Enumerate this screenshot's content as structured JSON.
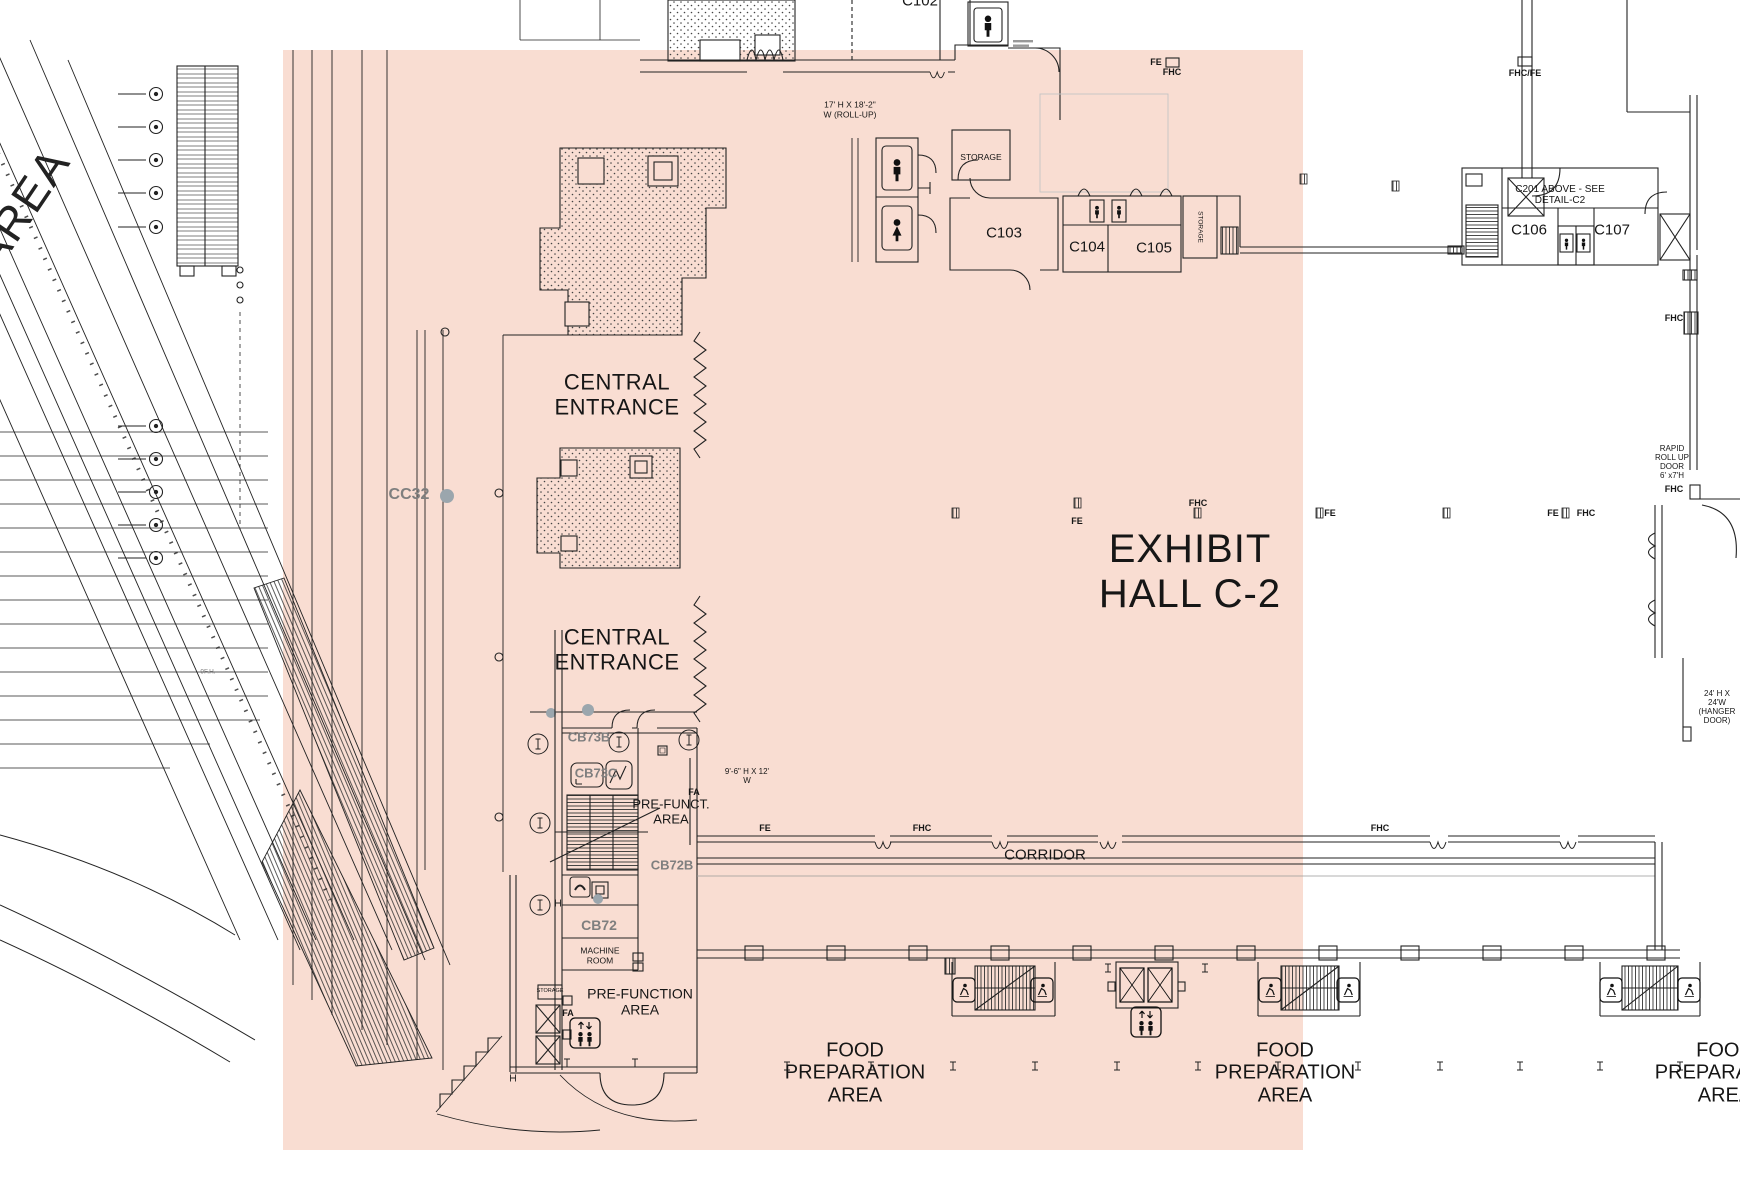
{
  "colors": {
    "highlight_fill": "#f9ddd2",
    "gray_label": "#7f7f7f",
    "grid_dot_gray": "#9ba6ad",
    "line_color": "#222222"
  },
  "hall": {
    "name": "EXHIBIT\nHALL C-2"
  },
  "labels": {
    "area": "AREA",
    "c102": "C102",
    "rollup_note": "17' H X 18'-2\"\nW (ROLL-UP)",
    "fe": "FE",
    "fhc": "FHC",
    "fhc_fe": "FHC/FE",
    "storage": "STORAGE",
    "c103": "C103",
    "c104": "C104",
    "c105": "C105",
    "c201_note": "C201 ABOVE - SEE\nDETAIL-C2",
    "c106": "C106",
    "c107": "C107",
    "central_entrance": "CENTRAL\nENTRANCE",
    "cc32": "CC32",
    "rapid_door": "RAPID\nROLL UP\nDOOR\n6' x7'H",
    "hanger_door": "24' H X 24'W\n(HANGER\nDOOR)",
    "cb73b": "CB73B",
    "cb73c": "CB73C",
    "cb72b": "CB72B",
    "cb72": "CB72",
    "fa": "FA",
    "pre_funct": "PRE-FUNCT.\nAREA",
    "pre_function": "PRE-FUNCTION\nAREA",
    "door_9_6": "9'-6\" H X 12'\nW",
    "corridor": "CORRIDOR",
    "machine_room": "MACHINE\nROOM",
    "food_prep": "FOOD\nPREPARATION\nAREA",
    "fh_note": "9F.H."
  }
}
